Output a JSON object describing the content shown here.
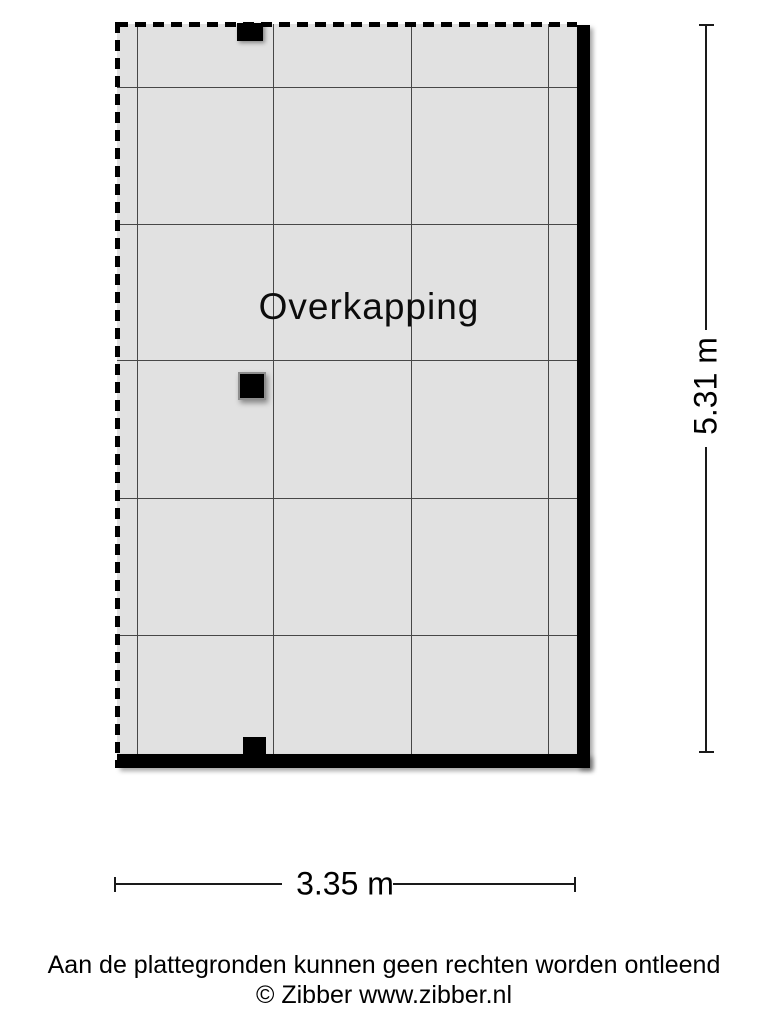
{
  "floorplan": {
    "room_label": "Overkapping",
    "dimensions": {
      "width": "3.35 m",
      "height": "5.31 m"
    },
    "walls": {
      "solid": [
        "right",
        "bottom"
      ],
      "open_dashed": [
        "top",
        "left"
      ]
    },
    "posts": [
      "top-edge",
      "center-left",
      "bottom-edge"
    ],
    "grid": {
      "vertical_lines": 4,
      "horizontal_lines": 5
    }
  },
  "footer": {
    "disclaimer": "Aan de plattegronden kunnen geen rechten worden ontleend",
    "copyright": "© Zibber www.zibber.nl"
  },
  "colors": {
    "floor_fill": "#e1e1e1",
    "grid_line": "#474747",
    "wall": "#000000",
    "text": "#000000",
    "background": "#ffffff"
  }
}
